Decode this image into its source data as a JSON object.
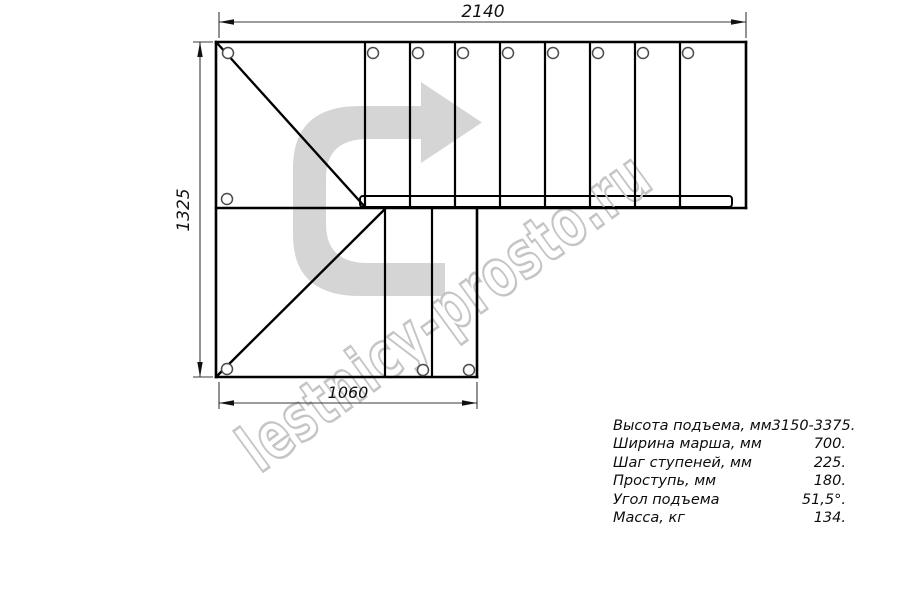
{
  "drawing": {
    "title": "staircase-plan-top-view",
    "dimension_top_mm": "2140",
    "dimension_left_mm": "1325",
    "dimension_bottom_mm": "1060",
    "watermark_text": "lestnicy-prosto.ru",
    "upper_flight_tread_count": 8,
    "lower_flight_tread_count": 2,
    "colors": {
      "line": "#000000",
      "dimension_line": "#3a3a3a",
      "arrow_fill": "#d5d5d5",
      "watermark_stroke": "#c5c5c5",
      "background": "#ffffff"
    }
  },
  "specs": {
    "rows": [
      {
        "label": "Высота подъема, мм",
        "value": "3150-3375."
      },
      {
        "label": "Ширина марша, мм",
        "value": "700."
      },
      {
        "label": "Шаг ступеней, мм",
        "value": "225."
      },
      {
        "label": "Проступь, мм",
        "value": "180."
      },
      {
        "label": "Угол подъема",
        "value": "51,5°."
      },
      {
        "label": "Масса, кг",
        "value": "134."
      }
    ]
  }
}
